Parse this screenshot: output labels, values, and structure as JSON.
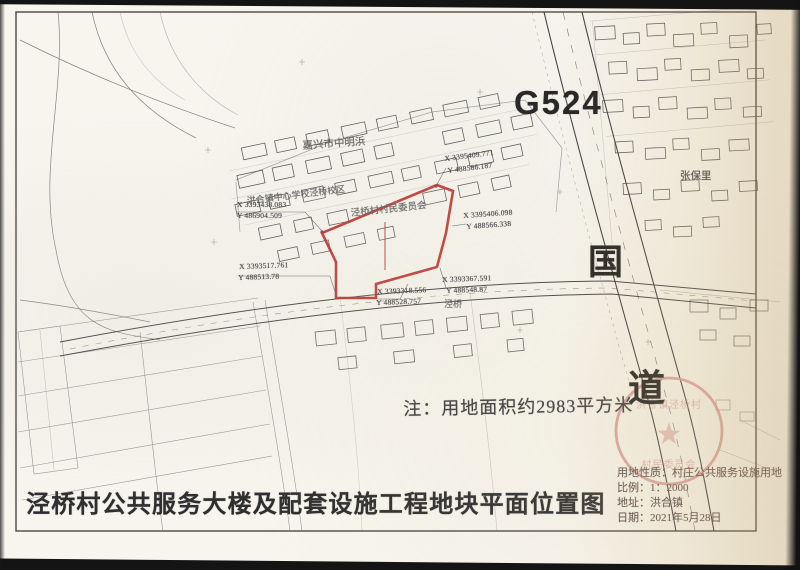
{
  "document": {
    "title": "泾桥村公共服务大楼及配套设施工程地块平面位置图",
    "note": "注：用地面积约2983平方米"
  },
  "road_labels": {
    "highway": "G524",
    "national_char_1": "国",
    "national_char_2": "道"
  },
  "map_labels": {
    "village_top": "嘉兴市中明浜",
    "school": "洪合镇中心学校泾桥校区",
    "parcel_owner": "泾桥村村民委员会",
    "hamlet_east": "张保里",
    "hamlet_south": "泾桥"
  },
  "survey_points": [
    {
      "x": "X 3393438.083",
      "y": "Y 486904.509"
    },
    {
      "x": "X 3395409.771",
      "y": "Y 488586.187"
    },
    {
      "x": "X 3395406.098",
      "y": "Y 488566.338"
    },
    {
      "x": "X 3393517.761",
      "y": "Y 488513.78"
    },
    {
      "x": "X 3393318.556",
      "y": "Y 488528.757"
    },
    {
      "x": "X 3393367.591",
      "y": "Y 488548.87"
    }
  ],
  "info_block": {
    "land_use": "用地性质：村庄公共服务设施用地",
    "scale": "比例：1：2000",
    "address": "地址：洪合镇",
    "date": "日期：2021年5月28日"
  },
  "stamp": {
    "line1": "洪合镇泾桥村",
    "line2": "村民委员会"
  },
  "colors": {
    "parcel_outline": "#b92b27",
    "stamp_red": "#d89595",
    "ink": "#3a3a3a"
  }
}
